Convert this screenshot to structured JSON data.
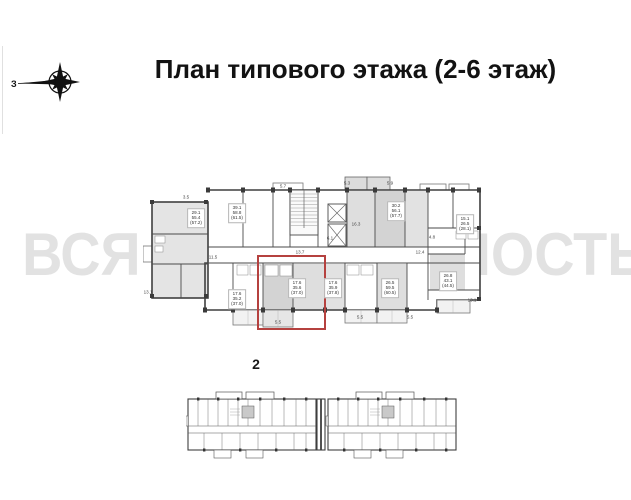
{
  "title": {
    "text": "План типового этажа (2-6 этаж)"
  },
  "compass": {
    "label": "З"
  },
  "watermark": {
    "text": "ВСЯ НЕДВИЖИМОСТЬ",
    "color": "#e2e2e2"
  },
  "section_label": "2",
  "colors": {
    "wall": "#3f3f3f",
    "room_shade_light": "#e2e2e2",
    "room_shade_mid": "#dedede",
    "room_shade_dark": "#d3d3d3",
    "highlight": "#b5413f",
    "watermark_gray": "#e2e2e2"
  },
  "main_plan": {
    "highlight_color": "#b5413f",
    "area_labels": [
      {
        "x": 196,
        "y": 218,
        "lines": [
          "29.1",
          "55.4",
          "(57.2)"
        ]
      },
      {
        "x": 237,
        "y": 213,
        "lines": [
          "39.1",
          "58.8",
          "(61.5)"
        ]
      },
      {
        "x": 396,
        "y": 211,
        "lines": [
          "30.2",
          "56.1",
          "(57.7)"
        ]
      },
      {
        "x": 465,
        "y": 224,
        "lines": [
          "15.1",
          "26.5",
          "(28.1)"
        ]
      },
      {
        "x": 237,
        "y": 299,
        "lines": [
          "17.6",
          "35.2",
          "(37.0)"
        ]
      },
      {
        "x": 297,
        "y": 288,
        "lines": [
          "17.6",
          "35.6",
          "(37.0)"
        ]
      },
      {
        "x": 333,
        "y": 288,
        "lines": [
          "17.6",
          "35.9",
          "(37.8)"
        ]
      },
      {
        "x": 390,
        "y": 288,
        "lines": [
          "26.5",
          "59.5",
          "(60.5)"
        ]
      },
      {
        "x": 448,
        "y": 281,
        "lines": [
          "26.8",
          "43.1",
          "(44.5)"
        ]
      }
    ],
    "dimension_marks": [
      {
        "x": 283,
        "y": 186,
        "text": "5.7"
      },
      {
        "x": 347,
        "y": 183,
        "text": "5.3"
      },
      {
        "x": 390,
        "y": 183,
        "text": "5.9"
      },
      {
        "x": 186,
        "y": 197,
        "text": "3.5"
      },
      {
        "x": 356,
        "y": 224,
        "text": "16.3"
      },
      {
        "x": 330,
        "y": 238,
        "text": "6.1"
      },
      {
        "x": 300,
        "y": 252,
        "text": "13.7"
      },
      {
        "x": 420,
        "y": 252,
        "text": "12.4"
      },
      {
        "x": 213,
        "y": 257,
        "text": "11.5"
      },
      {
        "x": 432,
        "y": 237,
        "text": "4.8"
      },
      {
        "x": 148,
        "y": 292,
        "text": "13.1"
      },
      {
        "x": 472,
        "y": 300,
        "text": "13.1"
      },
      {
        "x": 278,
        "y": 322,
        "text": "5.5"
      },
      {
        "x": 360,
        "y": 317,
        "text": "5.5"
      },
      {
        "x": 410,
        "y": 317,
        "text": "5.5"
      }
    ]
  }
}
